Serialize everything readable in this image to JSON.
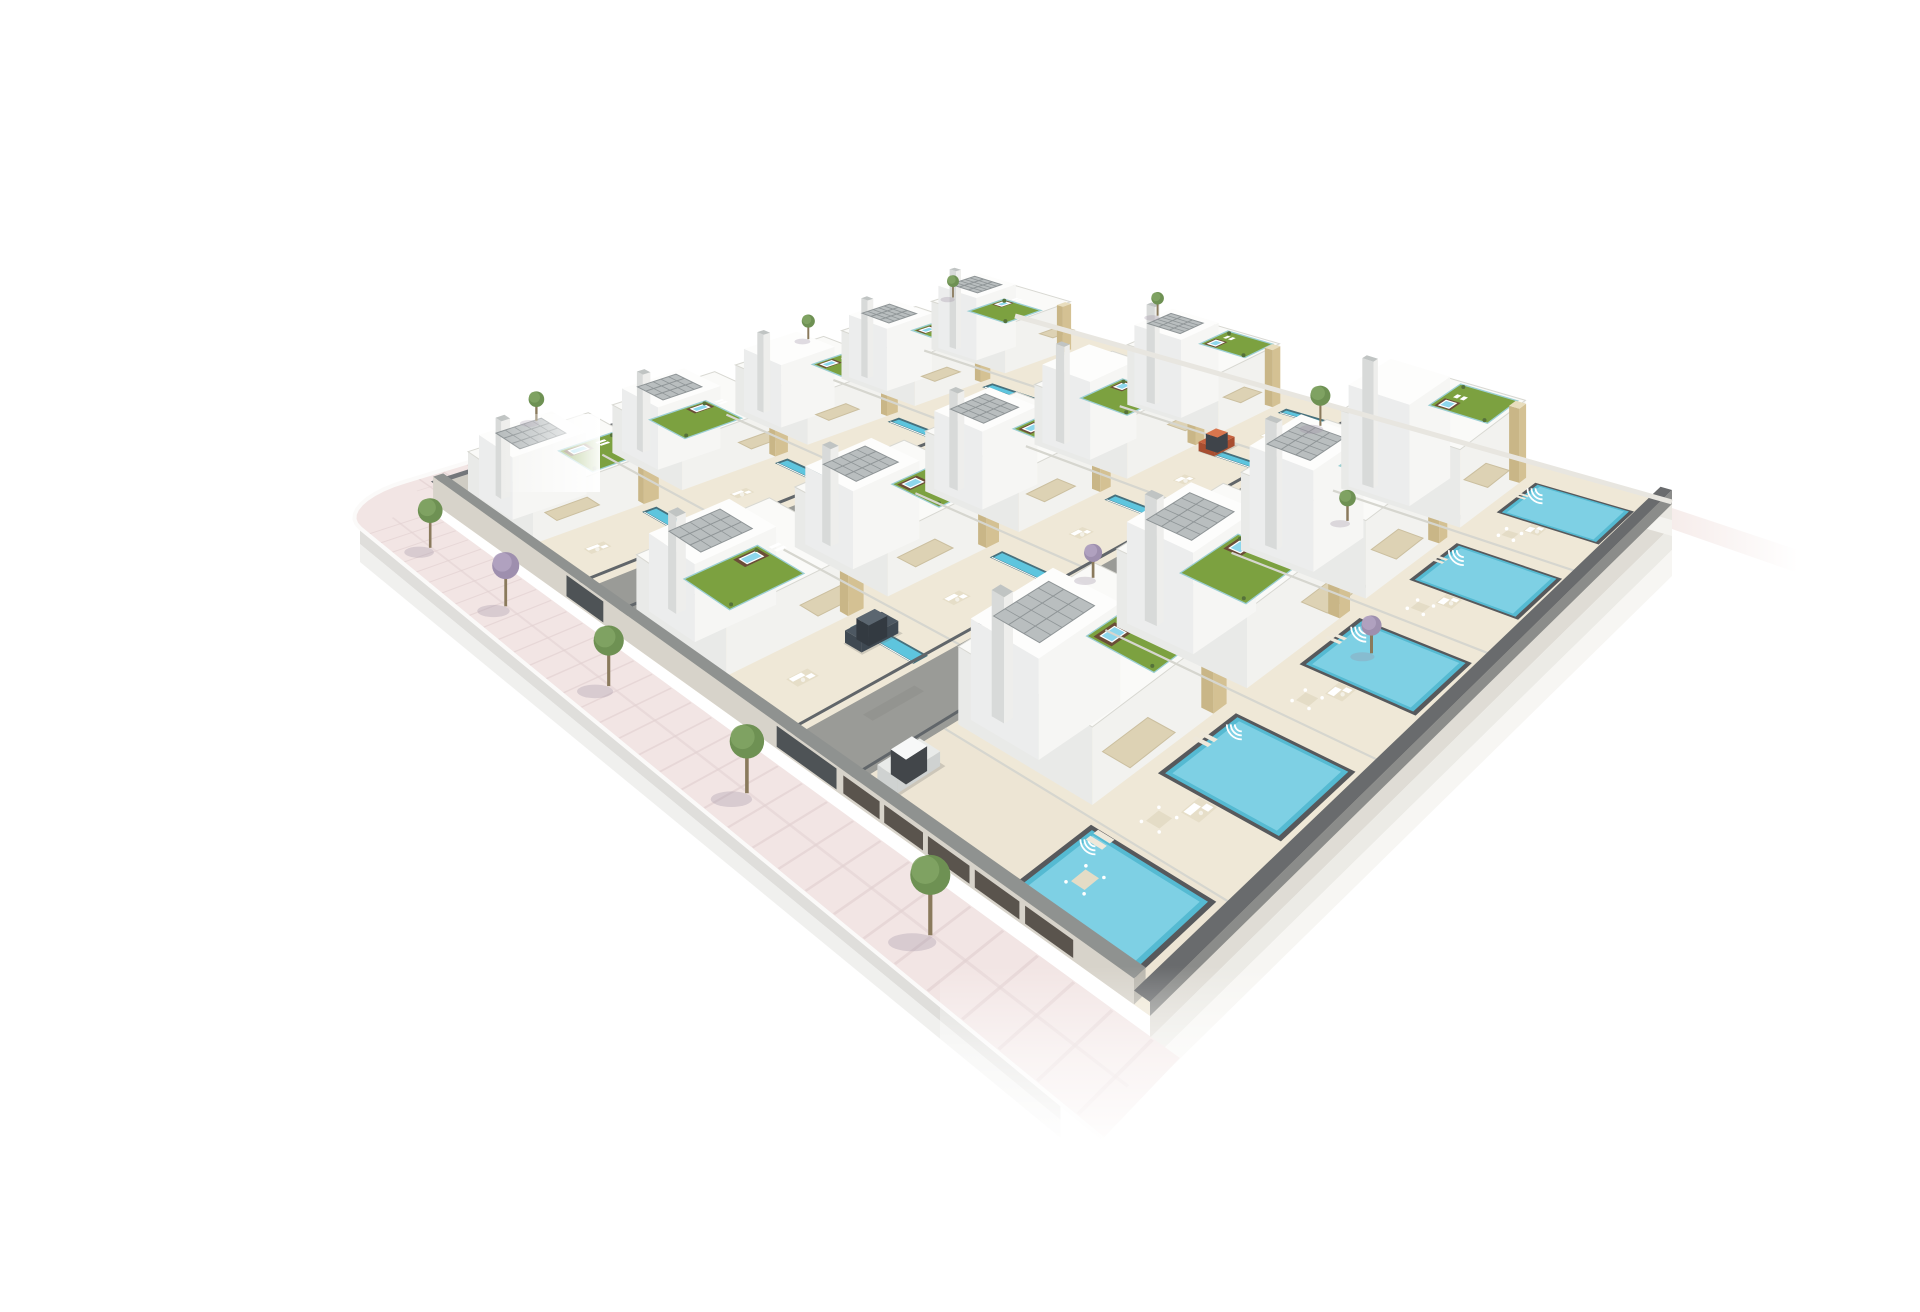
{
  "meta": {
    "title": "Aerial 3D render of a gated residential villa development",
    "description": "Photorealistic isometric-style architectural visualization: three diagonal rows of modern white villas with tan stone accents, rooftop gardens with jacuzzis, tilted solar panel arrays, cream terraces with outdoor furniture, long lap pools and large private mosaic pools, two internal grey streets with parked cars (orange hatchback, dark van, white hatchback in a garage court), a perimeter wall with garage doors and entrance gates, and a pink tiled sidewalk with trees curving around the lower-left corner. The cut-out site slab floats on a plain white background.",
    "inventory": {
      "villa_rows": 3,
      "villas_total": 14,
      "lap_pools": 10,
      "private_pools": 5,
      "roof_jacuzzis": 14,
      "internal_roads": 2,
      "entrance_gates": 2,
      "garage_doors": 5,
      "sidewalk_trees": 5,
      "garden_and_roof_trees": 8,
      "cars": 3
    }
  },
  "colors": {
    "background": "#ffffff",
    "terrace": "#efe8d7",
    "road": "#9a9b97",
    "roadDark": "#8b8c88",
    "sidewalk": "#f2e5e4",
    "sidewalkLine": "#e2d2d1",
    "curb": "#fbfaf9",
    "wallFace": "#d7d3ca",
    "wallCap": "#8f9290",
    "fenceDark": "#61666a",
    "slab": "#dfdcd5",
    "slabLight": "#ecebe6",
    "slabLighter": "#f7f6f3",
    "houseTop": "#fafaf8",
    "houseSide": "#e9eae8",
    "houseFront": "#f2f2ef",
    "parapet": "#d8d8d2",
    "stone": "#d4c193",
    "stoneTop": "#e8ddbd",
    "grass": "#7ca140",
    "gardenRail": "#9ccfd4",
    "solar": "#b9bebf",
    "solarLine": "#8f9597",
    "poolLap": "#5ec5de",
    "poolEdge": "#47707c",
    "poolBig": "#55bad2",
    "poolMosaic": "#83d3e5",
    "poolCoping": "#57595c",
    "jacuzziDeck": "#6b4d38",
    "jacuzziWater": "#8ed7ec",
    "awning": "#ddd2b4",
    "awningEdge": "#cbbf9f",
    "furnitureWhite": "#ffffff",
    "furnitureBeige": "#e4dcc6",
    "shadowGrey": "#757b77",
    "doorDark": "#5a544d",
    "gateDark": "#4e5356",
    "treeShadow": "#9b8fa2",
    "trunk": "#8a7a5c",
    "stubPink": "#f0e0dd",
    "tree": {
      "green": [
        "#6e9153",
        "#82a465"
      ],
      "purple": [
        "#9e8fae",
        "#b3a5c2"
      ]
    },
    "cars": {
      "orange": {
        "body": "#c8623e",
        "shade": "#a84e30",
        "roof": "#d8764e",
        "window": "#3f444a"
      },
      "white": {
        "body": "#e9ebe9",
        "shade": "#cfd2d1",
        "roof": "#f7f8f8",
        "window": "#42464a"
      },
      "van": {
        "body": "#4d5862",
        "shade": "#3f4952",
        "roof": "#5b6670",
        "window": "#333a41"
      }
    }
  },
  "site": {
    "corners": {
      "left": [
        395,
        488
      ],
      "top": [
        975,
        302
      ],
      "right": [
        1632,
        488
      ],
      "bottom": [
        1110,
        1000
      ]
    },
    "sidewalk": {
      "outer": -0.085,
      "inner": -0.012,
      "arm_end": 0.17,
      "corner_radius": 0.085
    },
    "rows": [
      {
        "name": "row-1",
        "house_v": [
          0.012,
          0.17
        ],
        "yard_v": [
          0.17,
          0.295
        ],
        "lift": 48,
        "parcels": [
          0.02,
          0.21,
          0.4,
          0.59,
          0.775,
          0.96
        ],
        "villas": [
          {
            "solar": true,
            "garden": "R"
          },
          {
            "solar": true,
            "garden": "L"
          },
          {
            "solar": false,
            "garden": "R"
          },
          {
            "solar": true,
            "garden": "R"
          },
          {
            "solar": true,
            "garden": "L"
          }
        ]
      },
      {
        "name": "row-2",
        "house_v": [
          0.37,
          0.52
        ],
        "yard_v": [
          0.52,
          0.63
        ],
        "lift": 60,
        "parcels": [
          0.02,
          0.215,
          0.41,
          0.605,
          0.8,
          0.985
        ],
        "villas": [
          {
            "solar": true,
            "garden": "L"
          },
          {
            "solar": true,
            "garden": "R"
          },
          {
            "solar": true,
            "garden": "R"
          },
          {
            "solar": false,
            "garden": "L"
          },
          {
            "solar": true,
            "garden": "R"
          }
        ]
      },
      {
        "name": "row-3",
        "house_v": [
          0.71,
          0.855
        ],
        "yard_v": [
          0.855,
          0.988
        ],
        "lift": 78,
        "parcels": [
          0.115,
          0.33,
          0.545,
          0.76,
          0.975
        ],
        "pool_v": [
          0.872,
          0.972
        ],
        "villas": [
          {
            "solar": true,
            "garden": "R"
          },
          {
            "solar": true,
            "garden": "L"
          },
          {
            "solar": true,
            "garden": "R"
          },
          {
            "solar": false,
            "garden": "R"
          }
        ]
      }
    ],
    "garage_court": {
      "u": [
        0.015,
        0.115
      ],
      "v": [
        0.71,
        0.988
      ],
      "pool_u": [
        0.022,
        0.105
      ],
      "dining": [
        0.062,
        0.9
      ],
      "loungers": [
        0.094,
        0.875
      ]
    },
    "roads": [
      {
        "name": "road-1",
        "v": [
          0.295,
          0.37
        ],
        "gate_v": [
          0.298,
          0.367
        ]
      },
      {
        "name": "road-2",
        "v": [
          0.63,
          0.71
        ],
        "gate_v": [
          0.633,
          0.707
        ]
      }
    ],
    "garage_doors": [
      [
        0.715,
        0.756
      ],
      [
        0.761,
        0.802
      ],
      [
        0.807,
        0.848
      ],
      [
        0.853,
        0.894
      ],
      [
        0.899,
        0.94
      ]
    ],
    "lap_pool": {
      "inset_right": 0.035,
      "width": 0.016
    }
  },
  "objects": {
    "trees": {
      "sidewalk": [
        {
          "u": -0.05,
          "v": 0.1,
          "type": "green"
        },
        {
          "u": -0.05,
          "v": 0.27,
          "type": "purple"
        },
        {
          "u": -0.05,
          "v": 0.46,
          "type": "green"
        },
        {
          "u": -0.05,
          "v": 0.66,
          "type": "green"
        },
        {
          "u": -0.05,
          "v": 0.86,
          "type": "green"
        }
      ],
      "garden": [
        {
          "u": 0.1,
          "v": 0.05,
          "lift": 70,
          "small": true,
          "type": "green"
        },
        {
          "u": 0.52,
          "v": 0.04,
          "lift": 58,
          "small": true,
          "type": "green"
        },
        {
          "u": 0.8,
          "v": 0.05,
          "lift": 55,
          "small": true,
          "type": "green"
        },
        {
          "u": 0.93,
          "v": 0.34,
          "lift": 62,
          "small": true,
          "type": "green"
        },
        {
          "u": 0.93,
          "v": 0.6,
          "lift": 0,
          "small": false,
          "type": "green"
        },
        {
          "u": 0.7,
          "v": 0.76,
          "lift": 0,
          "small": true,
          "type": "green"
        },
        {
          "u": 0.4,
          "v": 0.64,
          "lift": 0,
          "small": true,
          "type": "purple"
        },
        {
          "u": 0.47,
          "v": 0.905,
          "lift": 0,
          "small": true,
          "type": "purple"
        }
      ]
    },
    "cars": [
      {
        "type": "hatchback",
        "palette": "orange",
        "u": 0.77,
        "v": 0.545
      },
      {
        "type": "van",
        "palette": "van",
        "u": 0.165,
        "v": 0.565
      },
      {
        "type": "hatchback",
        "palette": "white",
        "u": 0.055,
        "v": 0.73
      }
    ]
  }
}
